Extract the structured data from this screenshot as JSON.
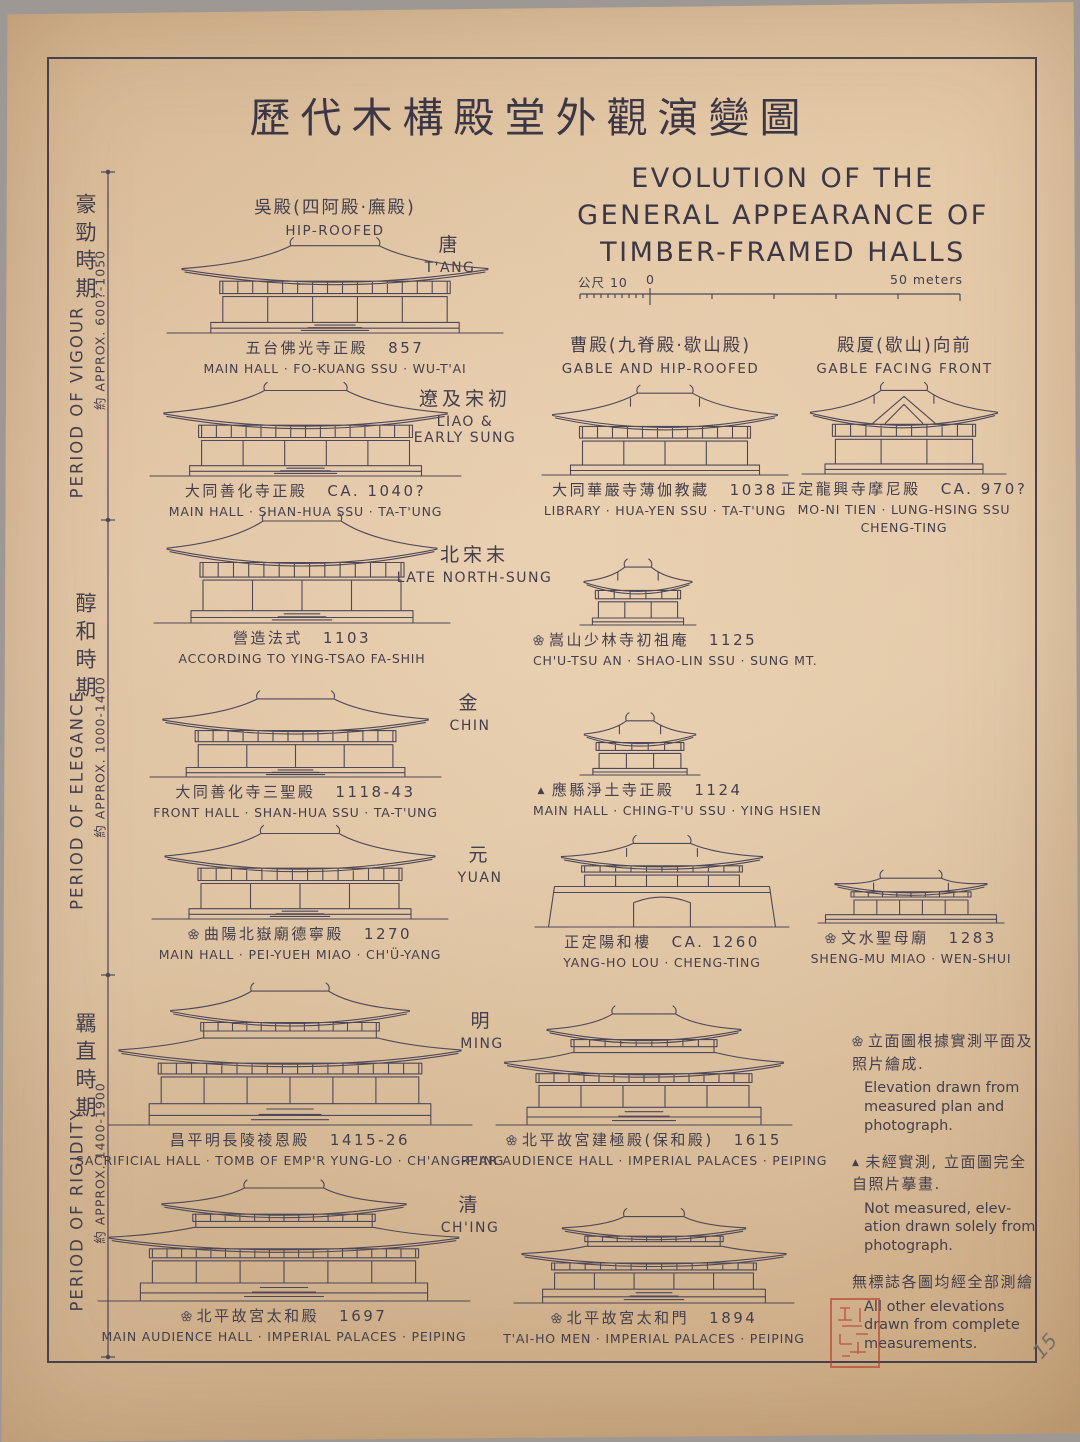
{
  "colors": {
    "paper": "#d9bc99",
    "ink": "#4e4857",
    "frame": "#47414d",
    "seal_red": "#ba3c2c"
  },
  "title": {
    "cn": "歷代木構殿堂外觀演變圖",
    "en_lines": [
      "EVOLUTION OF THE",
      "GENERAL APPEARANCE OF",
      "TIMBER-FRAMED HALLS"
    ]
  },
  "scale_bar": {
    "unit_left": "公尺 10",
    "zero": "0",
    "right": "50 meters"
  },
  "sidebar": {
    "sections": [
      {
        "cn": "豪勁時期",
        "en": "PERIOD OF VIGOUR",
        "approx": "約 APPROX. 600?-1050"
      },
      {
        "cn": "醇和時期",
        "en": "PERIOD OF ELEGANCE",
        "approx": "約 APPROX. 1000-1400"
      },
      {
        "cn": "羈直時期",
        "en": "PERIOD OF RIGIDITY",
        "approx": "約 APPROX. 1400-1900"
      }
    ]
  },
  "type_headers": [
    {
      "cn": "吳殿(四阿殿·廡殿)",
      "en": "HIP-ROOFED"
    },
    {
      "cn": "曹殿(九脊殿·歇山殿)",
      "en": "GABLE AND HIP-ROOFED"
    },
    {
      "cn": "殿厦(歇山)向前",
      "en": "GABLE FACING FRONT"
    }
  ],
  "era_labels": [
    {
      "cn": "唐",
      "en": "T'ANG"
    },
    {
      "cn": "遼及宋初",
      "en": "LIAO &",
      "en2": "EARLY SUNG"
    },
    {
      "cn": "北宋末",
      "en": "LATE NORTH-SUNG"
    },
    {
      "cn": "金",
      "en": "CHIN"
    },
    {
      "cn": "元",
      "en": "YUAN"
    },
    {
      "cn": "明",
      "en": "MING"
    },
    {
      "cn": "清",
      "en": "CH'ING"
    }
  ],
  "buildings": [
    {
      "id": "fo-kuang-ssu-main-hall",
      "kind": "hip",
      "x": 165,
      "y": 238,
      "w": 340,
      "h": 96,
      "marker": "",
      "cn": "五台佛光寺正殿",
      "date": "857",
      "en": [
        "MAIN HALL · FO-KUANG SSU · WU-T'AI"
      ]
    },
    {
      "id": "shan-hua-ssu-main-hall",
      "kind": "hip",
      "x": 148,
      "y": 383,
      "w": 315,
      "h": 94,
      "marker": "",
      "cn": "大同善化寺正殿",
      "date": "CA. 1040?",
      "en": [
        "MAIN HALL · SHAN-HUA SSU · TA-T'UNG"
      ]
    },
    {
      "id": "hua-yen-ssu-library",
      "kind": "gablehip",
      "x": 540,
      "y": 386,
      "w": 250,
      "h": 90,
      "marker": "",
      "cn": "大同華嚴寺薄伽教藏",
      "date": "1038",
      "en": [
        "LIBRARY · HUA-YEN SSU · TA-T'UNG"
      ]
    },
    {
      "id": "mo-ni-tien",
      "kind": "gablefront",
      "x": 800,
      "y": 383,
      "w": 208,
      "h": 92,
      "marker": "",
      "cn": "正定龍興寺摩尼殿",
      "date": "CA. 970?",
      "en": [
        "MO-NI TIEN · LUNG-HSING SSU",
        "CHENG-TING"
      ]
    },
    {
      "id": "ying-tsao-fa-shih",
      "kind": "hip",
      "x": 152,
      "y": 512,
      "w": 300,
      "h": 112,
      "marker": "",
      "cn": "營造法式",
      "date": "1103",
      "en": [
        "ACCORDING TO YING-TSAO FA-SHIH"
      ]
    },
    {
      "id": "chu-tsu-an",
      "kind": "gablehip",
      "x": 578,
      "y": 562,
      "w": 120,
      "h": 64,
      "marker": "flower",
      "cn": "嵩山少林寺初祖庵",
      "date": "1125",
      "en": [
        "CH'U-TSU AN · SHAO-LIN SSU · SUNG MT."
      ]
    },
    {
      "id": "shan-hua-ssu-front-hall",
      "kind": "hip",
      "x": 148,
      "y": 692,
      "w": 295,
      "h": 86,
      "marker": "",
      "cn": "大同善化寺三聖殿",
      "date": "1118-43",
      "en": [
        "FRONT HALL · SHAN-HUA SSU · TA-T'UNG"
      ]
    },
    {
      "id": "ching-tu-ssu-main-hall",
      "kind": "gablehip",
      "x": 578,
      "y": 716,
      "w": 124,
      "h": 60,
      "marker": "triangle",
      "cn": "應縣淨土寺正殿",
      "date": "1124",
      "en": [
        "MAIN HALL · CHING-T'U SSU · YING HSIEN"
      ]
    },
    {
      "id": "pei-yueh-miao-main-hall",
      "kind": "hip",
      "x": 150,
      "y": 826,
      "w": 300,
      "h": 94,
      "marker": "flower",
      "cn": "曲陽北嶽廟德寧殿",
      "date": "1270",
      "en": [
        "MAIN HALL · PEI-YUEH MIAO · CH'Ü-YANG"
      ]
    },
    {
      "id": "yang-ho-lou",
      "kind": "platform",
      "x": 533,
      "y": 838,
      "w": 258,
      "h": 90,
      "marker": "",
      "cn": "正定陽和樓",
      "date": "CA. 1260",
      "en": [
        "YANG-HO LOU · CHENG-TING"
      ]
    },
    {
      "id": "sheng-mu-miao",
      "kind": "lowhall",
      "x": 816,
      "y": 872,
      "w": 190,
      "h": 52,
      "marker": "flower",
      "cn": "文水聖母廟",
      "date": "1283",
      "en": [
        "SHENG-MU MIAO · WEN-SHUI"
      ]
    },
    {
      "id": "chang-ling-sacrificial-hall",
      "kind": "double",
      "x": 106,
      "y": 984,
      "w": 368,
      "h": 142,
      "marker": "",
      "cn": "昌平明長陵祾恩殿",
      "date": "1415-26",
      "en": [
        "SACRIFICIAL HALL · TOMB OF EMP'R YUNG-LO · CH'ANG-P'ING"
      ]
    },
    {
      "id": "pao-ho-tien",
      "kind": "double",
      "x": 494,
      "y": 1008,
      "w": 300,
      "h": 118,
      "marker": "flower",
      "cn": "北平故宮建極殿(保和殿)",
      "date": "1615",
      "en": [
        "REAR AUDIENCE HALL · IMPERIAL PALACES · PEIPING"
      ]
    },
    {
      "id": "tai-ho-tien",
      "kind": "double",
      "x": 96,
      "y": 1182,
      "w": 376,
      "h": 120,
      "marker": "flower",
      "cn": "北平故宮太和殿",
      "date": "1697",
      "en": [
        "MAIN AUDIENCE HALL · IMPERIAL PALACES · PEIPING"
      ]
    },
    {
      "id": "tai-ho-men",
      "kind": "double",
      "x": 512,
      "y": 1212,
      "w": 284,
      "h": 92,
      "marker": "flower",
      "cn": "北平故宮太和門",
      "date": "1894",
      "en": [
        "T'AI-HO MEN · IMPERIAL PALACES · PEIPING"
      ]
    }
  ],
  "legend": [
    {
      "marker": "flower",
      "cn": "立面圖根據實測平面及照片繪成.",
      "en": "Elevation drawn from measured plan and photograph."
    },
    {
      "marker": "triangle",
      "cn": "未經實測, 立面圖完全自照片摹畫.",
      "en": "Not measured, elev­ation drawn solely from photograph."
    },
    {
      "marker": "",
      "cn": "無標誌各圖均經全部測繪.",
      "en": "All other elevations drawn from comp­lete measurements."
    }
  ],
  "page_number": "15"
}
